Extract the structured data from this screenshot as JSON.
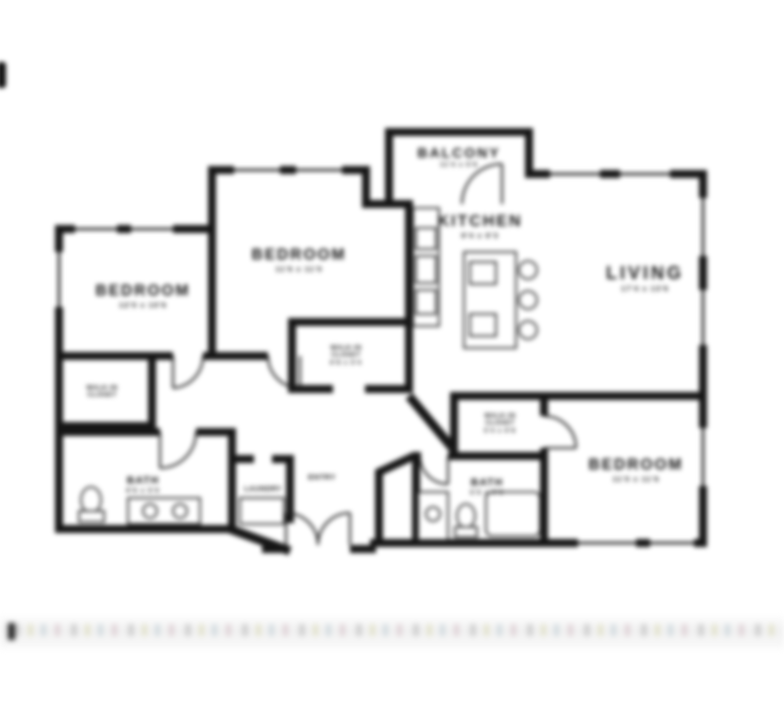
{
  "colors": {
    "wall": "#161616",
    "text": "#111111",
    "fixture_stroke": "#2a2a2a",
    "background": "#ffffff"
  },
  "rooms": {
    "balcony": {
      "label": "BALCONY",
      "dims": "11'4 x 5'6"
    },
    "kitchen": {
      "label": "KITCHEN",
      "dims": "9'4 x 9'3"
    },
    "living": {
      "label": "LIVING",
      "dims": "17'4 x 13'6"
    },
    "bedroom_top_left": {
      "label": "BEDROOM",
      "dims": "12'0 x 10'6"
    },
    "bedroom_top_middle": {
      "label": "BEDROOM",
      "dims": "11'6 x 11'0"
    },
    "bedroom_bottom_right": {
      "label": "BEDROOM",
      "dims": "11'0 x 11'6"
    },
    "bath_left": {
      "label": "BATH",
      "dims": "9'6 x 5'0"
    },
    "bath_right": {
      "label": "BATH",
      "dims": "5'0 x 9'6"
    },
    "wic_left": {
      "line1": "WALK-IN",
      "line2": "CLOSET"
    },
    "wic_middle": {
      "line1": "WALK-IN",
      "line2": "CLOSET",
      "dims": "6'8 x 5'4"
    },
    "wic_right": {
      "line1": "WALK-IN",
      "line2": "CLOSET",
      "dims": "5'4 x 6'8"
    },
    "laundry": {
      "label": "LAUNDRY"
    },
    "entry": {
      "label": "ENTRY"
    }
  }
}
